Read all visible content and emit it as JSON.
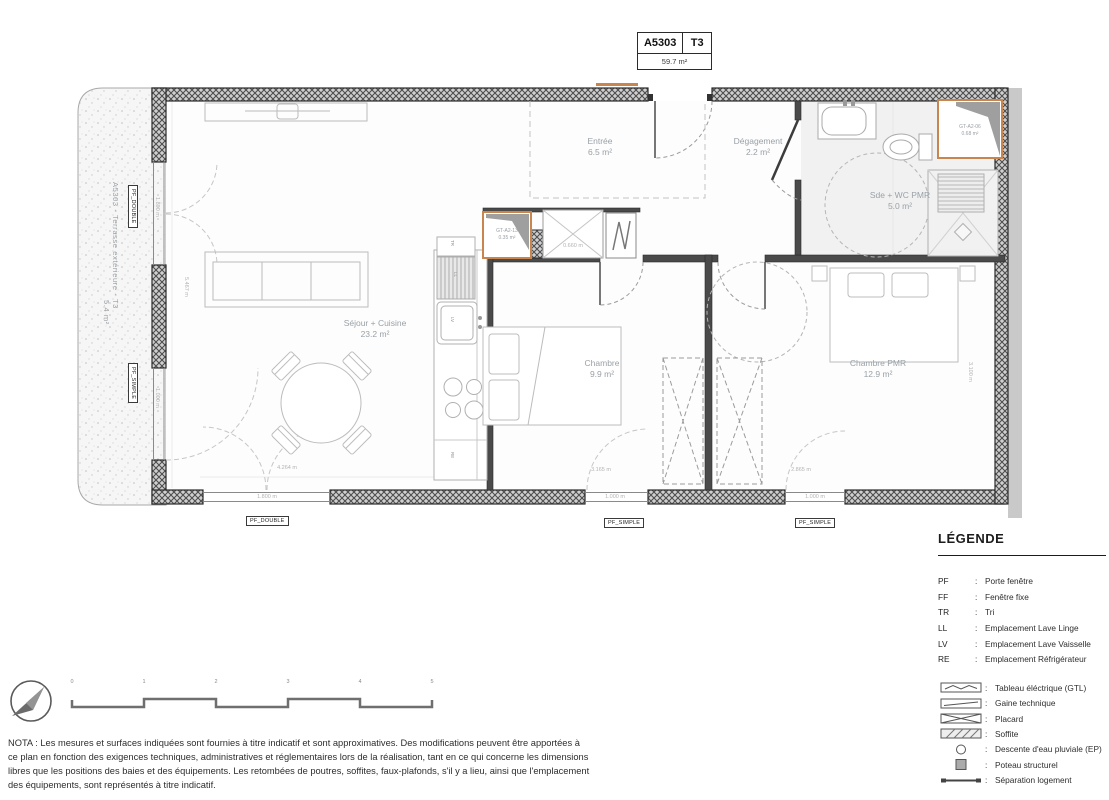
{
  "title_block": {
    "unit": "A5303",
    "type": "T3",
    "area": "59.7 m²"
  },
  "terrace": {
    "label": "A5303 - Terrasse extérieure - T3",
    "area": "5.4 m²"
  },
  "rooms": {
    "entree": {
      "name": "Entrée",
      "area": "6.5 m²"
    },
    "degagement": {
      "name": "Dégagement",
      "area": "2.2 m²"
    },
    "sde": {
      "name": "Sde + WC PMR",
      "area": "5.0 m²"
    },
    "sejour": {
      "name": "Séjour + Cuisine",
      "area": "23.2 m²"
    },
    "chambre": {
      "name": "Chambre",
      "area": "9.9 m²"
    },
    "chambre_pmr": {
      "name": "Chambre PMR",
      "area": "12.9 m²"
    },
    "gt06": {
      "name": "GT-A2-06",
      "area": "0.68 m²"
    },
    "gt13": {
      "name": "GT-A2-13",
      "area": "0.35 m²"
    }
  },
  "tags": {
    "pf_double": "PF_DOUBLE",
    "pf_simple": "PF_SIMPLE",
    "tr": "TR",
    "ll": "LL",
    "lv": "LV",
    "re": "RE"
  },
  "dims": {
    "left_window_top": "1.800 m",
    "left_window_bottom": "1.000 m",
    "bottom_window_left": "1.800 m",
    "bottom_window_mid": "1.000 m",
    "bottom_window_right": "1.000 m",
    "placard_entree": "0.660 m",
    "sejour_width": "4.264 m",
    "sejour_height": "5.467 m",
    "chambre_width": "3.165 m",
    "chambre_pmr_width": "2.865 m",
    "chambre_pmr_height": "3.100 m"
  },
  "legend": {
    "title": "LÉGENDE",
    "sep": ":",
    "abbreviations": [
      {
        "abbr": "PF",
        "label": "Porte fenêtre"
      },
      {
        "abbr": "FF",
        "label": "Fenêtre fixe"
      },
      {
        "abbr": "TR",
        "label": "Tri"
      },
      {
        "abbr": "LL",
        "label": "Emplacement Lave Linge"
      },
      {
        "abbr": "LV",
        "label": "Emplacement Lave Vaisselle"
      },
      {
        "abbr": "RE",
        "label": "Emplacement Réfrigérateur"
      }
    ],
    "symbols": [
      {
        "icon": "gtl-symbol",
        "label": "Tableau éléctrique (GTL)"
      },
      {
        "icon": "gaine-symbol",
        "label": "Gaine technique"
      },
      {
        "icon": "placard-symbol",
        "label": "Placard"
      },
      {
        "icon": "soffite-symbol",
        "label": "Soffite"
      },
      {
        "icon": "ep-symbol",
        "label": "Descente d'eau pluviale (EP)"
      },
      {
        "icon": "poteau-symbol",
        "label": "Poteau structurel"
      },
      {
        "icon": "separation-symbol",
        "label": "Séparation logement"
      }
    ]
  },
  "scale_bar": {
    "labels": [
      "0",
      "1",
      "2",
      "3",
      "4",
      "5"
    ]
  },
  "nota": "NOTA : Les mesures et surfaces indiquées sont fournies à titre indicatif et sont approximatives. Des modifications peuvent être apportées à ce plan en fonction des exigences techniques, administratives et réglementaires lors de la réalisation, tant en ce qui concerne les dimensions libres que les positions des baies et des équipements. Les retombées de poutres, soffites, faux-plafonds, s'il y a lieu, ainsi que l'emplacement des équipements, sont représentés à titre indicatif.",
  "colors": {
    "accent_orange": "#c8864e",
    "wall_dark": "#3c3c3c"
  }
}
